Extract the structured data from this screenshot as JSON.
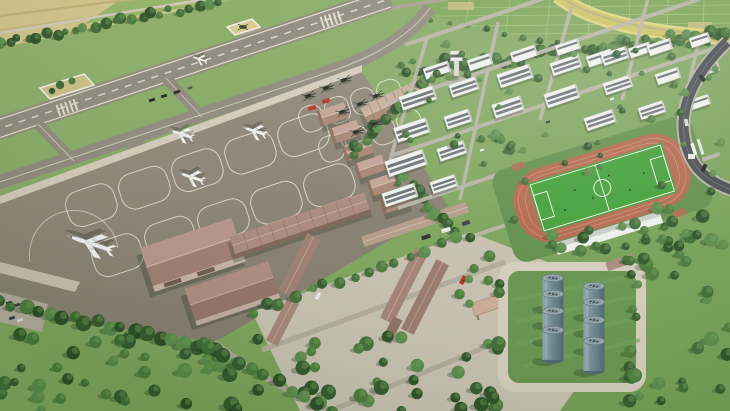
{
  "meta": {
    "title": "Aerial 3D rendering of an airport complex masterplan",
    "type": "architectural-visualization",
    "view": "oblique aerial"
  },
  "scene": {
    "areas": [
      {
        "name": "runway",
        "label": "Main runway"
      },
      {
        "name": "parallel-taxiway",
        "label": "Parallel taxiway with connectors"
      },
      {
        "name": "apron",
        "label": "Aircraft parking apron with marked stands"
      },
      {
        "name": "helipad",
        "label": "Helipad square"
      },
      {
        "name": "landscaped-square",
        "label": "Landscaped tree square"
      },
      {
        "name": "hangar-row",
        "label": "Row of hangar bays along apron edge"
      },
      {
        "name": "maintenance-hangar",
        "label": "Large maintenance hangars"
      },
      {
        "name": "cargo-warehouse-row",
        "label": "Long cargo warehouse rows"
      },
      {
        "name": "campus",
        "label": "Campus of white multi-storey buildings among trees"
      },
      {
        "name": "stadium",
        "label": "Football pitch with running track and grandstand"
      },
      {
        "name": "fuel-tank-farm",
        "label": "Fuel storage tank farm"
      },
      {
        "name": "logistics-yard",
        "label": "Logistics yard with warehouses and canopy"
      },
      {
        "name": "farmland-northwest",
        "label": "Tan farmland beyond tree row"
      },
      {
        "name": "farmland-northeast",
        "label": "Green field plots with curved highway ramp"
      },
      {
        "name": "access-road-east",
        "label": "Dark curved access road with gate"
      },
      {
        "name": "forest",
        "label": "Dense tree belts and scattered parkland trees"
      }
    ],
    "counts": {
      "fixed_wing_aircraft": 5,
      "helicopters": 8,
      "fuel_tanks": 8,
      "hangar_bays": 6,
      "campus_buildings": 27,
      "landscaped_squares": 2
    },
    "palette": {
      "grass": "#7da45c",
      "runway_asphalt": "#8e897c",
      "apron_concrete": "#8d8577",
      "sidewalk": "#d3cbb9",
      "hangar_roof": "#b09084",
      "building_white": "#eef0ec",
      "window_band": "#575d63",
      "track_red": "#b2664c",
      "pitch_green": "#3f9e35",
      "tank_steel": "#6c8893",
      "tree_green": "#46743a",
      "farmland_tan": "#d2c48a",
      "highway_yellow": "#cfc565",
      "road_dark": "#45494d",
      "fire_truck_red": "#b13227"
    }
  }
}
